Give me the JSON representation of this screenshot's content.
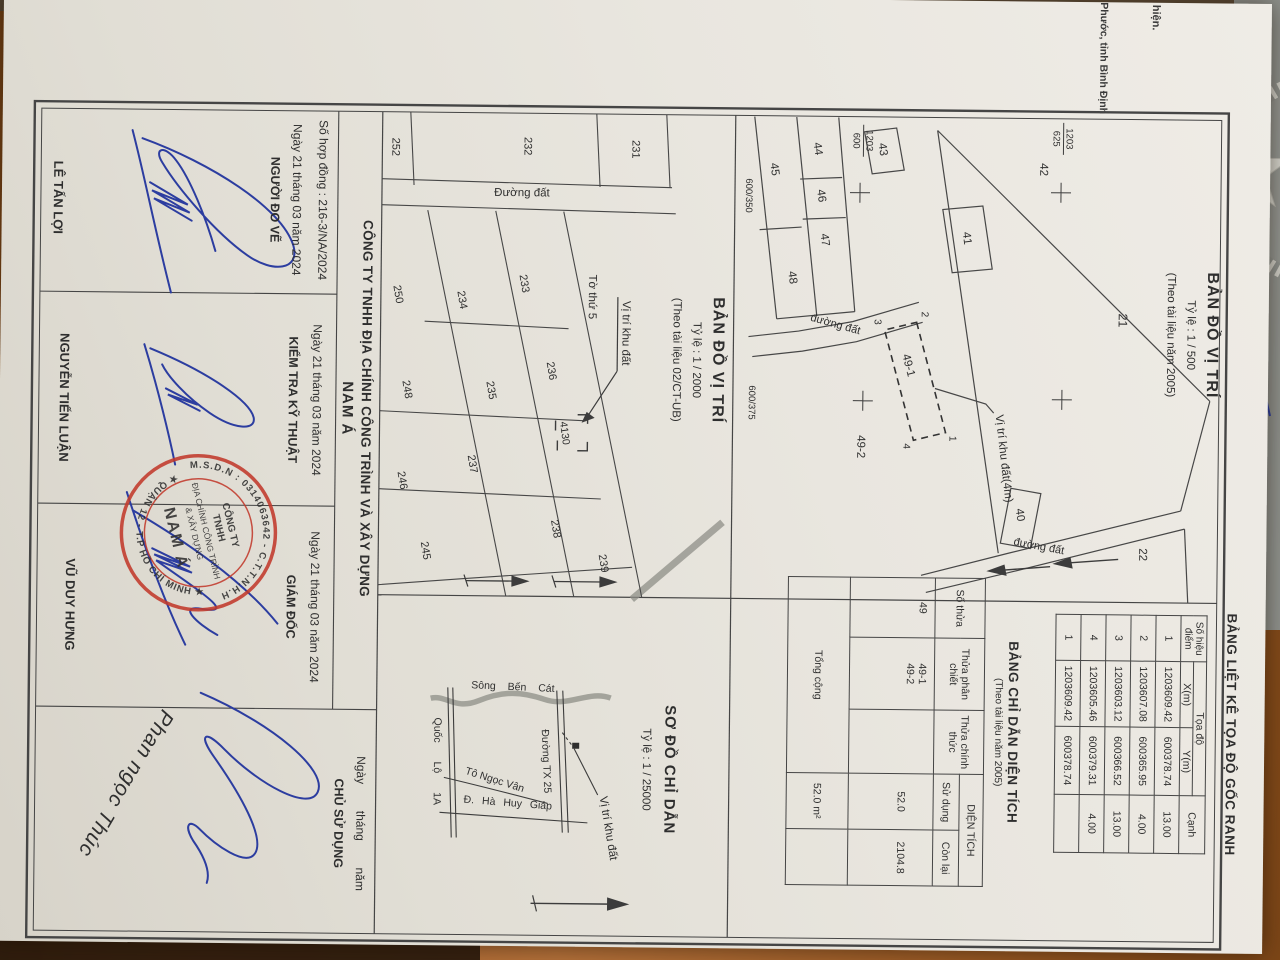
{
  "doc": {
    "margin_note_line1": "hiện.",
    "margin_note_line2": "Phước, tỉnh Bình Định"
  },
  "coord_table": {
    "title": "BẢNG LIỆT KÊ TỌA ĐỘ GỐC RANH",
    "col_point": "Số hiệu điểm",
    "col_group": "Tọa độ",
    "col_x": "X(m)",
    "col_y": "Y(m)",
    "col_edge": "Cạnh",
    "rows": [
      [
        "1",
        "1203609.42",
        "600378.74",
        "13.00"
      ],
      [
        "2",
        "1203607.08",
        "600365.95",
        "4.00"
      ],
      [
        "3",
        "1203603.12",
        "600366.52",
        "13.00"
      ],
      [
        "4",
        "1203605.46",
        "600379.31",
        "4.00"
      ],
      [
        "1",
        "1203609.42",
        "600378.74",
        ""
      ]
    ]
  },
  "area_table": {
    "title": "BẢNG CHỈ DẪN DIỆN TÍCH",
    "subtitle": "(Theo tài liệu năm 2005)",
    "col_parcel": "Số thửa",
    "col_split": "Thửa phân chiết",
    "col_official": "Thửa chính thức",
    "col_area": "DIỆN TÍCH",
    "col_used": "Sử dụng",
    "col_remain": "Còn lại",
    "row_parcel": "49",
    "row_split_1": "49-1",
    "row_split_2": "49-2",
    "row_used": "52.0",
    "row_remain": "2104.8",
    "total_label": "Tổng cộng",
    "total_value": "52.0 m²"
  },
  "map1": {
    "title": "BẢN ĐỒ VỊ TRÍ",
    "scale": "Tỷ lệ : 1 / 500",
    "source": "(Theo tài liệu năm 2005)",
    "p21": "21",
    "p22": "22",
    "p40": "40",
    "p41": "41",
    "p42": "42",
    "p43": "43",
    "p44": "44",
    "p45": "45",
    "p46": "46",
    "p47": "47",
    "p48": "48",
    "p49_1": "49-1",
    "p49_2": "49-2",
    "v1": "1",
    "v2": "2",
    "v3": "3",
    "v4": "4",
    "road": "đường đất",
    "site": "Vị trí khu đất(4m)",
    "grid_f1_num": "1203",
    "grid_f1_den": "625",
    "grid_f2_num": "1203",
    "grid_f2_den": "600",
    "grid_b1": "600/350",
    "grid_b2": "600/375"
  },
  "map2": {
    "title": "BẢN ĐỒ VỊ TRÍ",
    "scale": "Tỷ lệ : 1 / 2000",
    "source": "(Theo tài liệu 02/CT-UB)",
    "p231": "231",
    "p232": "232",
    "p233": "233",
    "p234": "234",
    "p235": "235",
    "p236": "236",
    "p237": "237",
    "p238": "238",
    "p239": "239",
    "p245": "245",
    "p246": "246",
    "p248": "248",
    "p250": "250",
    "p252": "252",
    "sheet": "Tờ thứ 5",
    "site": "Vị trí khu đất",
    "target": "4130",
    "road": "Đường đất"
  },
  "sketch": {
    "title": "SƠ ĐỒ CHỈ DẪN",
    "scale": "Tỷ lệ : 1 / 25000",
    "river": "Sông Bến Cát",
    "road_tx25": "Đường TX 25",
    "road_tnv": "Tô Ngọc Vân",
    "road_hhg": "Đ. Hà Huy Giáp",
    "road_ql1a": "Quốc Lộ 1A",
    "site": "Vị trí khu đất"
  },
  "title_block": {
    "company_line": "CÔNG TY TNHH ĐỊA CHÍNH CÔNG TRÌNH VÀ XÂY DỰNG",
    "company_name": "NAM Á",
    "contract": "Số hợp đồng : 216-3/NA/2024",
    "date1": "Ngày 21 tháng 03 năm 2024",
    "date2": "Ngày 21 tháng 03 năm 2024",
    "date3": "Ngày 21 tháng 03 năm 2024",
    "date_blank": "Ngày        tháng        năm",
    "role1": "NGƯỜI ĐO VẼ",
    "role2": "KIỂM TRA KỸ THUẬT",
    "role3": "GIÁM ĐỐC",
    "role4": "CHỦ SỬ DỤNG",
    "name1": "LÊ TẤN LỢI",
    "name2": "NGUYỄN TIẾN LUẬN",
    "name3": "VŨ DUY HƯNG",
    "signed_name": "Phan ngọc Thúc"
  },
  "stamp": {
    "ring_top": "M.S.D.N : 0314063642 - C.T.T.N.H.H",
    "ring_bottom": "★ QUẬN 12 - T.P HỒ CHÍ MINH ★",
    "line1": "CÔNG TY",
    "line2": "TNHH",
    "line3": "ĐỊA CHÍNH CÔNG TRÌNH",
    "line4": "& XÂY DỰNG",
    "line5": "NAM Á",
    "color": "#c23a2c"
  },
  "colors": {
    "paper": "#e9e6df",
    "ink_blue": "#2c3da0",
    "stamp_red": "#c23a2c",
    "line": "#454545",
    "wood": "#a9622a"
  }
}
